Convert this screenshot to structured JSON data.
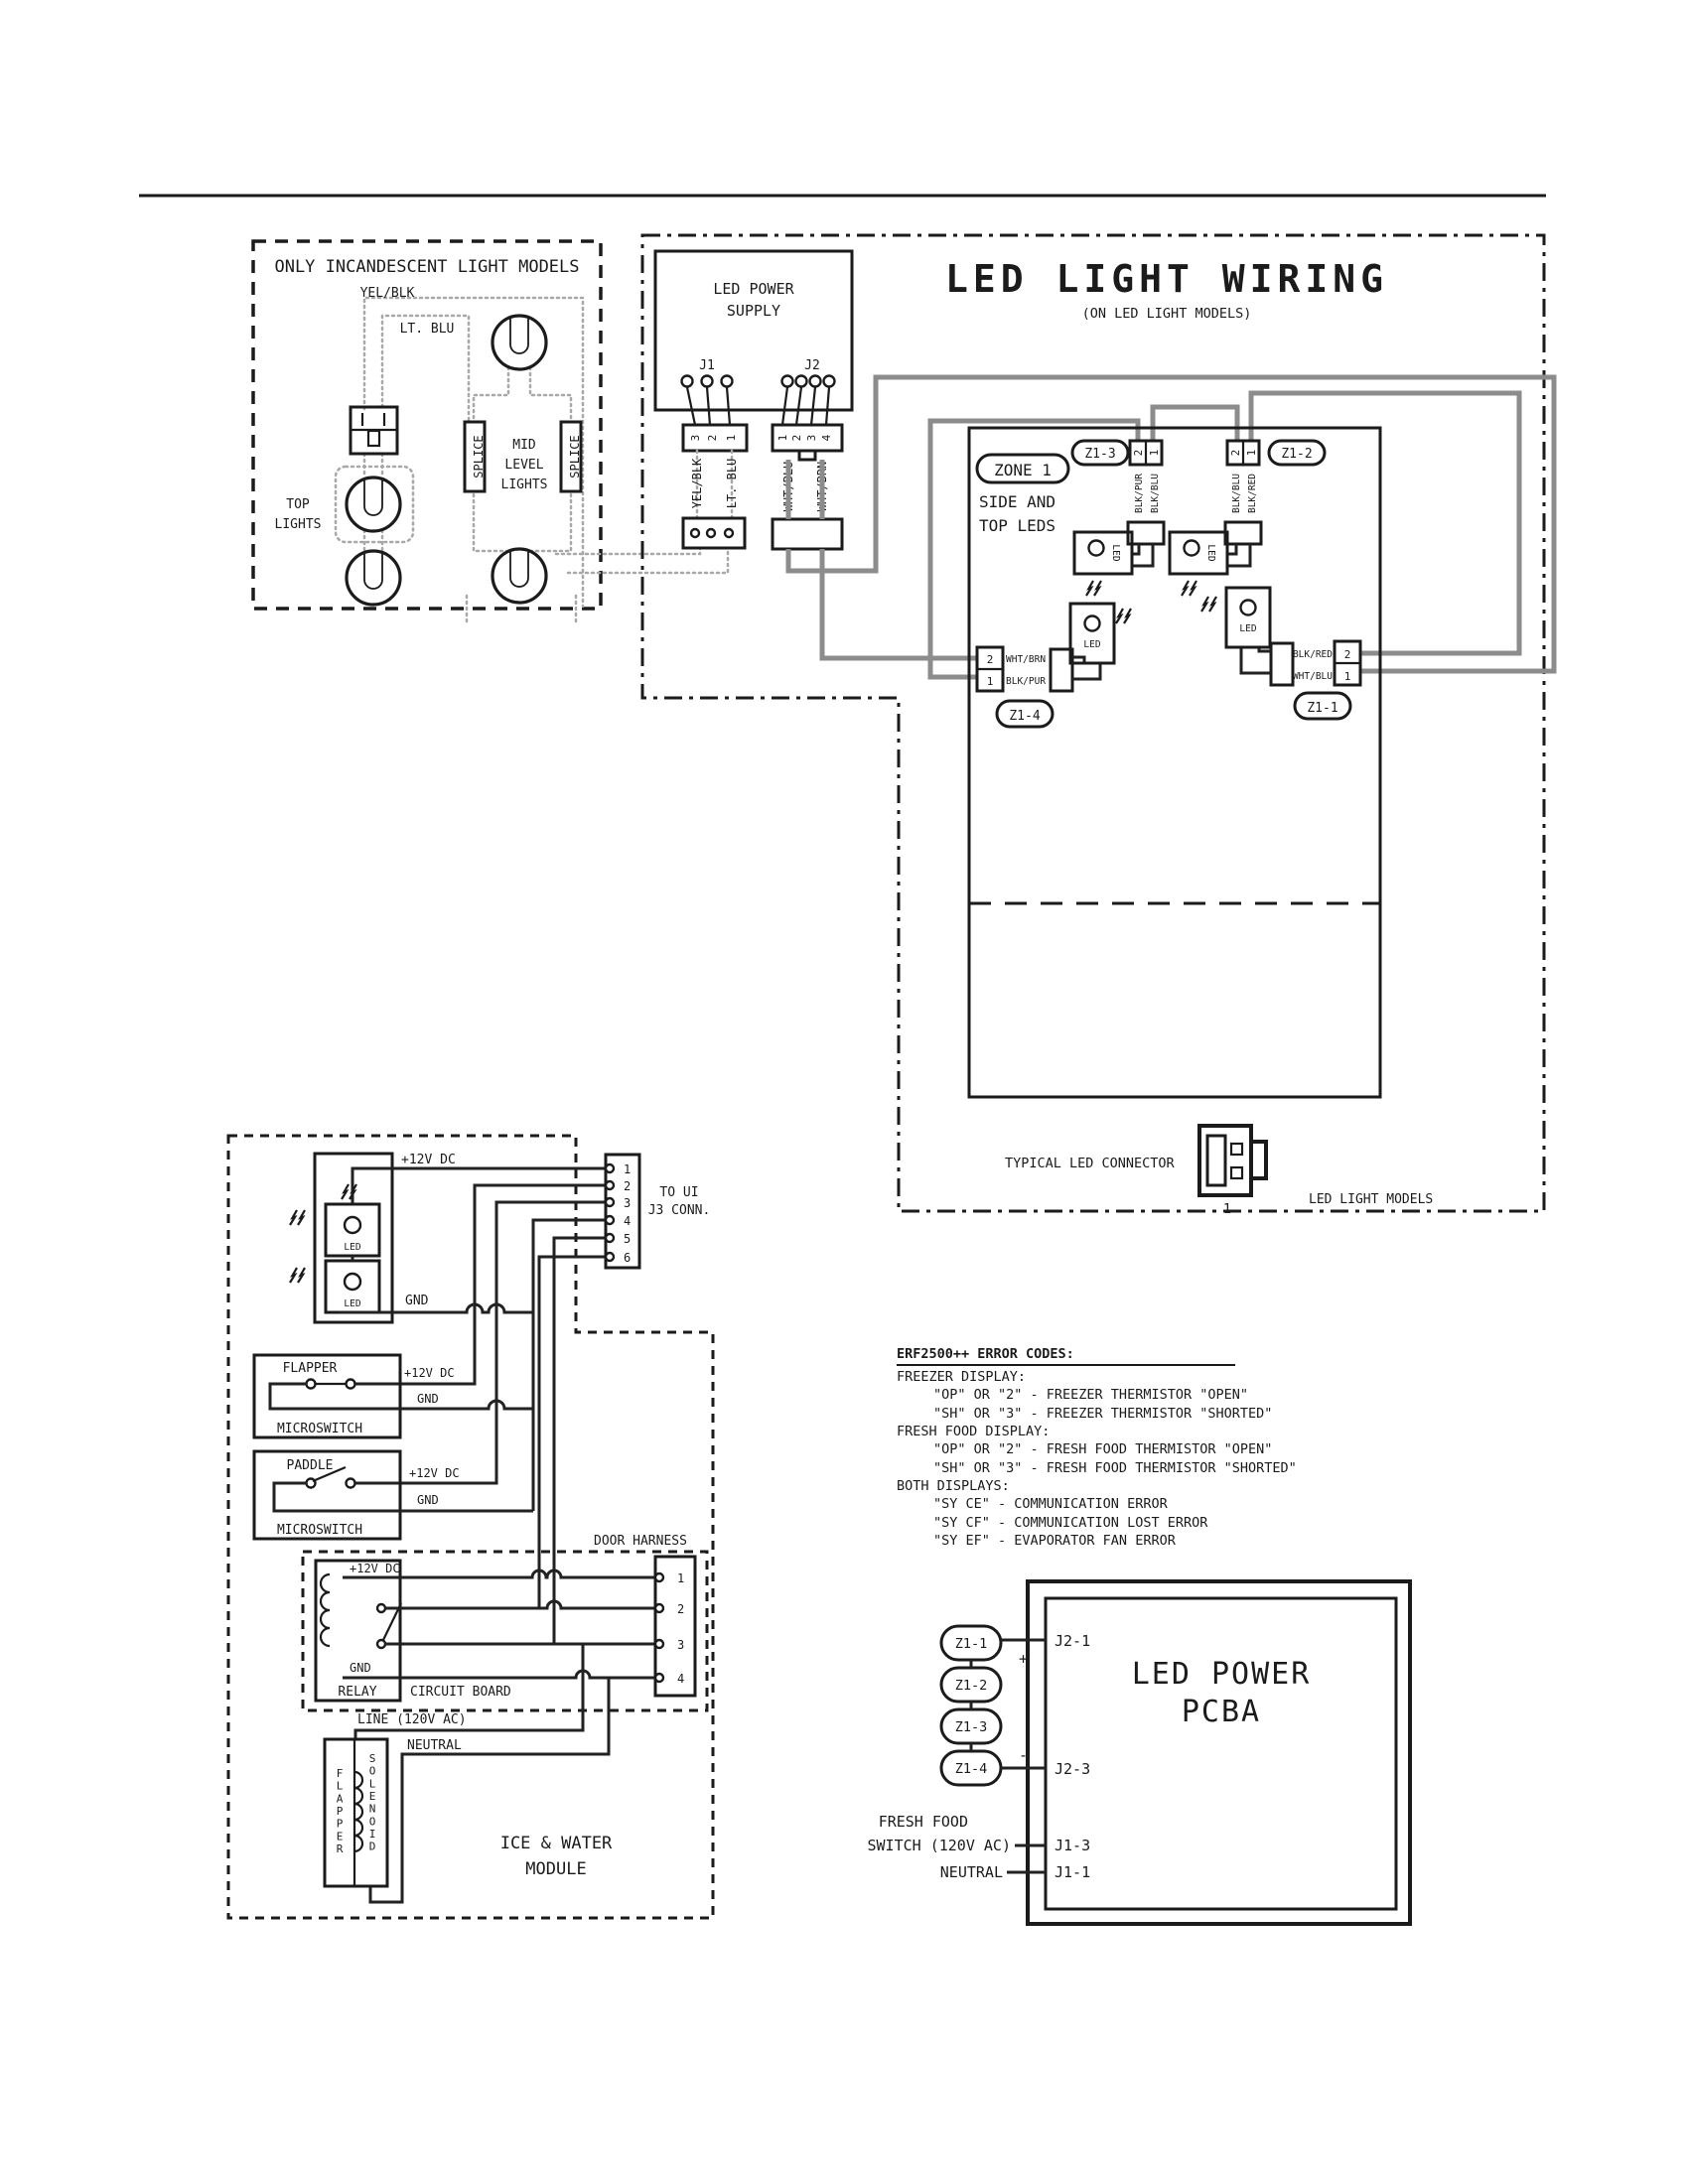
{
  "incandescent": {
    "title": "ONLY INCANDESCENT LIGHT MODELS",
    "yel_blk": "YEL/BLK",
    "lt_blu": "LT. BLU",
    "top1": "TOP",
    "top2": "LIGHTS",
    "mid1": "MID",
    "mid2": "LEVEL",
    "mid3": "LIGHTS",
    "splice": "SPLICE"
  },
  "led": {
    "title": "LED LIGHT WIRING",
    "subtitle": "(ON LED LIGHT MODELS)",
    "psu1": "LED POWER",
    "psu2": "SUPPLY",
    "j1": "J1",
    "j2": "J2",
    "j1_pins": {
      "p3": "3",
      "p2": "2",
      "p1": "1"
    },
    "j2_pins": {
      "p1": "1",
      "p2": "2",
      "p3": "3",
      "p4": "4"
    },
    "w_yel_blk": "YEL/BLK",
    "w_lt_blu": "LT. BLU",
    "w_wht_blu": "WHT/BLU",
    "w_wht_brn": "WHT/BRN",
    "zone": "ZONE 1",
    "zone_l1": "SIDE AND",
    "zone_l2": "TOP LEDS",
    "z13": "Z1-3",
    "z12": "Z1-2",
    "z14": "Z1-4",
    "z11": "Z1-1",
    "pin2": "2",
    "pin1": "1",
    "blk_pur": "BLK/PUR",
    "blk_blu": "BLK/BLU",
    "blk_red": "BLK/RED",
    "wht_brn": "WHT/BRN",
    "wht_blu": "WHT/BLU",
    "led": "LED",
    "typical": "TYPICAL LED CONNECTOR",
    "one": "1",
    "footer": "LED LIGHT MODELS"
  },
  "ui": {
    "v12": "+12V DC",
    "gnd": "GND",
    "to_ui1": "TO UI",
    "to_ui2": "J3 CONN.",
    "led": "LED",
    "pins": {
      "p1": "1",
      "p2": "2",
      "p3": "3",
      "p4": "4",
      "p5": "5",
      "p6": "6"
    }
  },
  "sw": {
    "flapper": "FLAPPER",
    "paddle": "PADDLE",
    "micro": "MICROSWITCH",
    "v12": "+12V DC",
    "gnd": "GND"
  },
  "dh": {
    "label": "DOOR HARNESS",
    "v12": "+12V DC",
    "gnd": "GND",
    "relay": "RELAY",
    "board": "CIRCUIT BOARD",
    "pins": {
      "p1": "1",
      "p2": "2",
      "p3": "3",
      "p4": "4"
    },
    "line": "LINE (120V AC)",
    "neutral": "NEUTRAL",
    "flapper_v": "FLAPPER",
    "solenoid_v": "SOLENOID",
    "module1": "ICE & WATER",
    "module2": "MODULE"
  },
  "err": {
    "heading": "ERF2500++ ERROR CODES:",
    "lines": [
      "FREEZER DISPLAY:",
      "\"OP\" OR \"2\" - FREEZER THERMISTOR \"OPEN\"",
      "\"SH\" OR \"3\" - FREEZER THERMISTOR \"SHORTED\"",
      "FRESH FOOD DISPLAY:",
      "\"OP\" OR \"2\" - FRESH FOOD THERMISTOR \"OPEN\"",
      "\"SH\" OR \"3\" - FRESH FOOD THERMISTOR \"SHORTED\"",
      "BOTH DISPLAYS:",
      "\"SY CE\" - COMMUNICATION ERROR",
      "\"SY CF\" - COMMUNICATION LOST ERROR",
      "\"SY EF\" - EVAPORATOR FAN ERROR"
    ]
  },
  "pcba": {
    "title1": "LED POWER",
    "title2": "PCBA",
    "z11": "Z1-1",
    "z12": "Z1-2",
    "z13": "Z1-3",
    "z14": "Z1-4",
    "plus": "+",
    "minus": "-",
    "j21": "J2-1",
    "j23": "J2-3",
    "j13": "J1-3",
    "j11": "J1-1",
    "ff1": "FRESH FOOD",
    "ff2": "SWITCH (120V AC)",
    "neutral": "NEUTRAL"
  }
}
